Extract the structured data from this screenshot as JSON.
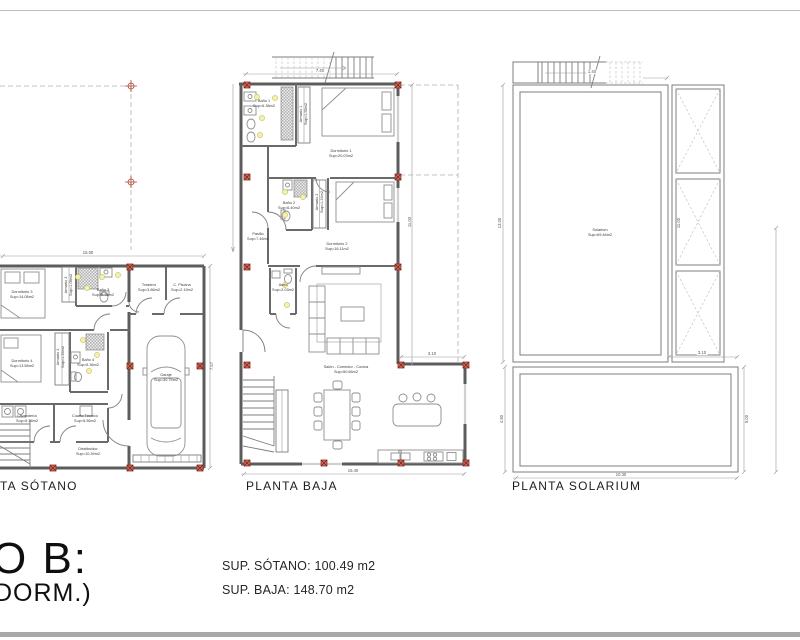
{
  "colors": {
    "wall": "#5c5c5c",
    "accent_marker": "#b04332",
    "highlight": "#f5f2a6",
    "divider": "#a9a9a9"
  },
  "plans": {
    "sotano": {
      "title": "TA SÓTANO",
      "rooms": {
        "dorm3": {
          "name": "Dormitorio 3",
          "sup": "Sup=14.08m2"
        },
        "arm3": {
          "name": "Armario 3",
          "sup": "Sup=1.06m2"
        },
        "bano3": {
          "name": "Baño 3",
          "sup": "Sup=5.36m2"
        },
        "trastero": {
          "name": "Trastero",
          "sup": "Sup=3.86m2"
        },
        "cpiscina": {
          "name": "C. Piscina",
          "sup": "Sup=2.19m2"
        },
        "dorm4": {
          "name": "Dormitorio 4",
          "sup": "Sup=13.58m2"
        },
        "arm4": {
          "name": "Armario 4",
          "sup": "Sup=1.34m2"
        },
        "bano4": {
          "name": "Baño 4",
          "sup": "Sup=5.36m2"
        },
        "lavanderia": {
          "name": "Lavandería",
          "sup": "Sup=5.36m2"
        },
        "ctecnico": {
          "name": "Cuarto Técnico",
          "sup": "Sup=5.56m2"
        },
        "distribuidor": {
          "name": "Distribuidor",
          "sup": "Sup=10.39m2"
        },
        "garaje": {
          "name": "Garaje",
          "sup": "Sup=30.75m2"
        }
      },
      "dims": {
        "top": "15.00",
        "right": "7.57"
      }
    },
    "baja": {
      "title": "PLANTA BAJA",
      "rooms": {
        "dorm1": {
          "name": "Dormitorio 1",
          "sup": "Sup=20.03m2"
        },
        "bano1": {
          "name": "Baño 1",
          "sup": "Sup=6.38m2"
        },
        "arm1": {
          "name": "Armario 1",
          "sup": "Sup=1.56m2"
        },
        "dorm2": {
          "name": "Dormitorio 2",
          "sup": "Sup=16.11m2"
        },
        "bano2": {
          "name": "Baño 2",
          "sup": "Sup=6.40m2"
        },
        "arm2": {
          "name": "Armario 2",
          "sup": "Sup=1.24m2"
        },
        "pasillo": {
          "name": "Pasillo",
          "sup": "Sup=7.46m2"
        },
        "aseo": {
          "name": "Aseo",
          "sup": "Sup=2.03m2"
        },
        "salon": {
          "name": "Salón - Comedor - Cocina",
          "sup": "Sup=50.66m2"
        }
      },
      "dims": {
        "top": "7.40",
        "right": "11.00",
        "ext": "3.10",
        "bottom": "15.40"
      }
    },
    "solarium": {
      "title": "PLANTA SOLARIUM",
      "rooms": {
        "solarium": {
          "name": "Solarium",
          "sup": "Sup=69.48m2"
        }
      },
      "dims": {
        "stair": "1.40",
        "left": "13.00",
        "mid": "11.00",
        "left_lower": "4.80",
        "right_lower": "5.00",
        "col": "3.10",
        "bottom": "10.30"
      }
    }
  },
  "titleblock": {
    "big_line1": "O B:",
    "big_line2": "DORM.)",
    "spec_sotano": "SUP. SÓTANO: 100.49 m2",
    "spec_baja": "SUP. BAJA: 148.70 m2"
  }
}
